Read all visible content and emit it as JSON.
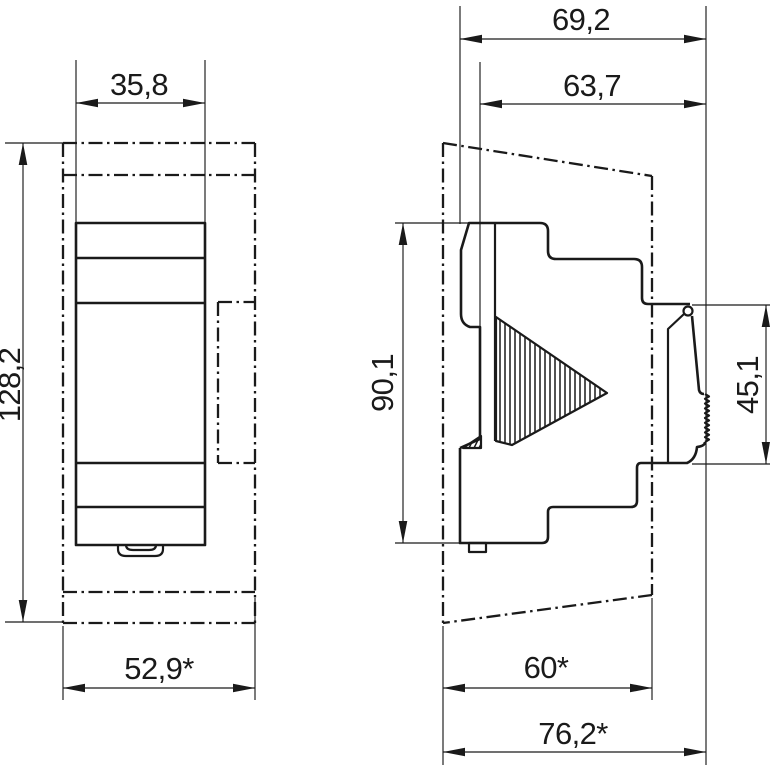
{
  "drawing": {
    "type": "dimensioned technical drawing, DIN-rail device, front and side views",
    "colors": {
      "line": "#1a1a1a",
      "background": "#ffffff"
    },
    "dims": {
      "front_width": "35,8",
      "front_height": "128,2",
      "front_cutout_width": "52,9*",
      "side_depth_total": "69,2",
      "side_depth_front": "63,7",
      "side_height": "90,1",
      "side_rear_height": "45,1",
      "side_cutout_depth": "60*",
      "side_total_depth": "76,2*"
    }
  }
}
